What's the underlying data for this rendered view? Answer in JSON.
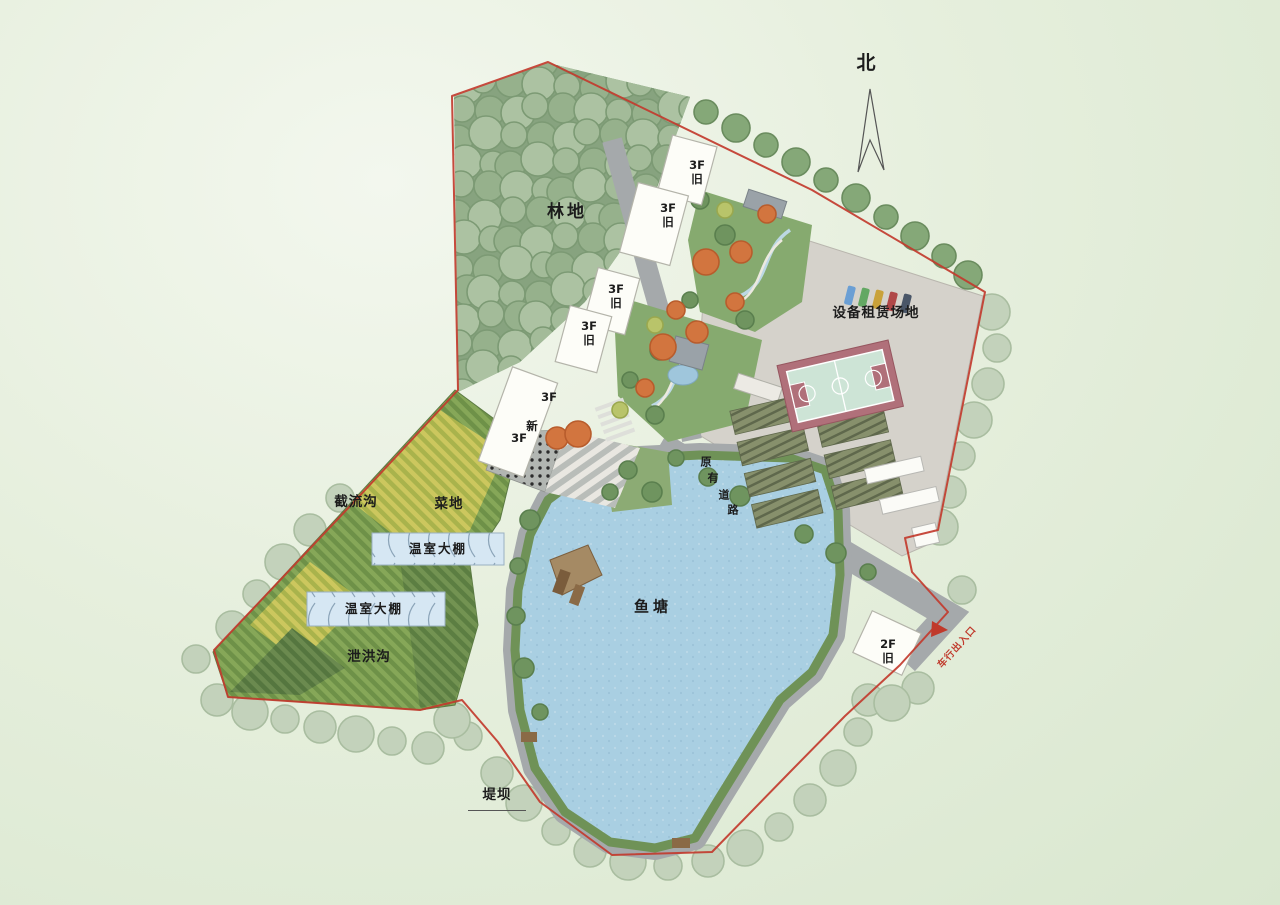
{
  "north": {
    "label": "北"
  },
  "labels": {
    "forest": "林地",
    "equipment_yard": "设备租赁场地",
    "interception_ditch": "截流沟",
    "vegetable_field": "菜地",
    "greenhouse_1": "温室大棚",
    "greenhouse_2": "温室大棚",
    "flood_discharge_ditch": "泄洪沟",
    "fish_pond": "鱼塘",
    "dam": "堤坝",
    "vehicle_entrance": "车行出入口",
    "existing_road_chars": [
      "原",
      "有",
      "道",
      "路"
    ]
  },
  "buildings": [
    {
      "floors": "3F",
      "status": "旧"
    },
    {
      "floors": "3F",
      "status": "旧"
    },
    {
      "floors": "3F",
      "status": "旧"
    },
    {
      "floors": "3F",
      "status": "旧"
    },
    {
      "floors": "2F",
      "status": "旧"
    }
  ],
  "new_building": {
    "label_top": "3F",
    "label_mid": "新",
    "label_bottom": "3F"
  },
  "colors": {
    "boundary_red": "#c23b2e",
    "pond_blue": "#a9cfe2",
    "forest_green": "#93ad8c",
    "paved_gray": "#d4d1ca",
    "road_gray": "#a5a9ab",
    "court_border": "#b0707a",
    "court_inner": "#cde4d6",
    "entrance_red": "#c0392b",
    "greenhouse_fill": "#d6e7f3"
  }
}
